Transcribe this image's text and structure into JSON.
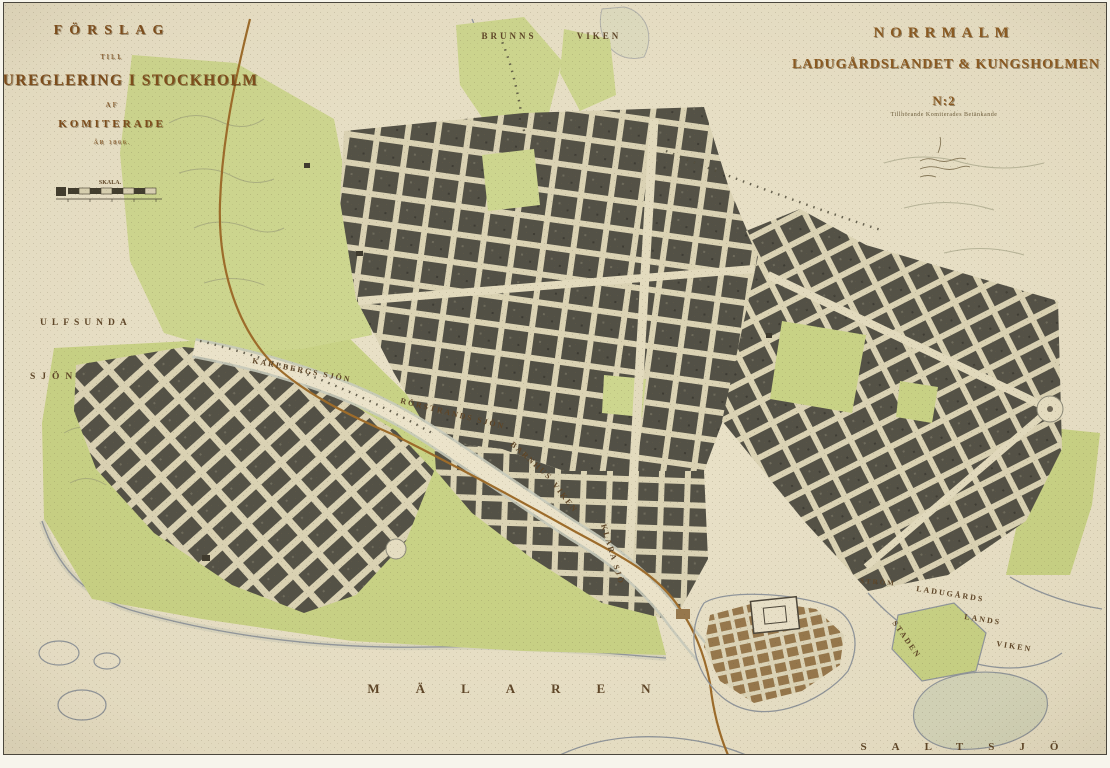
{
  "titles": {
    "left": {
      "line1": "FÖRSLAG",
      "line2": "TILL",
      "line3": "GATUREGLERING I STOCKHOLM",
      "line4": "AF",
      "line5": "KOMITERADE",
      "line6": "ÅR 1866.",
      "scale_label": "SKALA."
    },
    "right": {
      "line1": "NORRMALM",
      "line2": "LADUGÅRDSLANDET & KUNGSHOLMEN",
      "sheet": "N:2",
      "subtitle": "Tillhörande Komiterades Betänkande"
    }
  },
  "map": {
    "colors": {
      "paper": "#e8e0c6",
      "city_block": "#514f44",
      "park_green": "#c8d284",
      "old_town_brown": "#95764a",
      "railway_orange": "#9c6a28",
      "label_brown": "#5d4426",
      "shoreline_gray": "#8f959b"
    },
    "labels": [
      {
        "name": "label-brunnsviken-1",
        "text": "BRUNNS",
        "x": 505,
        "y": 36,
        "size": 9,
        "ls": 3,
        "anchor": "middle"
      },
      {
        "name": "label-brunnsviken-2",
        "text": "VIKEN",
        "x": 595,
        "y": 36,
        "size": 9,
        "ls": 3,
        "anchor": "middle"
      },
      {
        "name": "label-ulfsunda",
        "text": "ULFSUNDA",
        "x": 36,
        "y": 322,
        "size": 9.5,
        "ls": 5,
        "anchor": "start"
      },
      {
        "name": "label-sjon",
        "text": "SJÖN",
        "x": 26,
        "y": 376,
        "size": 9.5,
        "ls": 6,
        "anchor": "start"
      },
      {
        "name": "label-karlbergs-sjon",
        "text": "KARLBERGS SJÖN",
        "x": 248,
        "y": 360,
        "size": 8,
        "ls": 2,
        "rot": 11,
        "anchor": "start"
      },
      {
        "name": "label-rorstrands-sjon",
        "text": "RÖRSTRANDS SJÖN",
        "x": 396,
        "y": 400,
        "size": 8,
        "ls": 2,
        "rot": 14,
        "anchor": "start"
      },
      {
        "name": "label-barnhus",
        "text": "BARNHUS",
        "x": 506,
        "y": 442,
        "size": 8,
        "ls": 2,
        "rot": 42,
        "anchor": "start"
      },
      {
        "name": "label-barnhus-viken",
        "text": "VIKEN",
        "x": 548,
        "y": 482,
        "size": 8,
        "ls": 2,
        "rot": 52,
        "anchor": "start"
      },
      {
        "name": "label-klara-sjo",
        "text": "KLARA SJÖ",
        "x": 597,
        "y": 522,
        "size": 8,
        "ls": 2,
        "rot": 73,
        "anchor": "start"
      },
      {
        "name": "label-malaren",
        "text": "MÄLAREN",
        "x": 523,
        "y": 690,
        "size": 13,
        "ls": 36,
        "anchor": "middle"
      },
      {
        "name": "label-saltsjon",
        "text": "SALTSJÖ",
        "x": 968,
        "y": 747,
        "size": 11,
        "ls": 25,
        "anchor": "middle"
      },
      {
        "name": "label-ladugards",
        "text": "LADUGÅRDS",
        "x": 912,
        "y": 588,
        "size": 8,
        "ls": 2,
        "rot": 9,
        "anchor": "start"
      },
      {
        "name": "label-lands",
        "text": "LANDS",
        "x": 960,
        "y": 616,
        "size": 8,
        "ls": 2,
        "rot": 9,
        "anchor": "start"
      },
      {
        "name": "label-ladugards-viken",
        "text": "VIKEN",
        "x": 992,
        "y": 643,
        "size": 8,
        "ls": 2,
        "rot": 9,
        "anchor": "start"
      },
      {
        "name": "label-strom",
        "text": "STRÖM",
        "x": 856,
        "y": 580,
        "size": 7,
        "ls": 2,
        "rot": 4,
        "anchor": "start"
      },
      {
        "name": "label-staden",
        "text": "STADEN",
        "x": 888,
        "y": 620,
        "size": 8,
        "ls": 2,
        "rot": 55,
        "anchor": "start"
      }
    ]
  }
}
